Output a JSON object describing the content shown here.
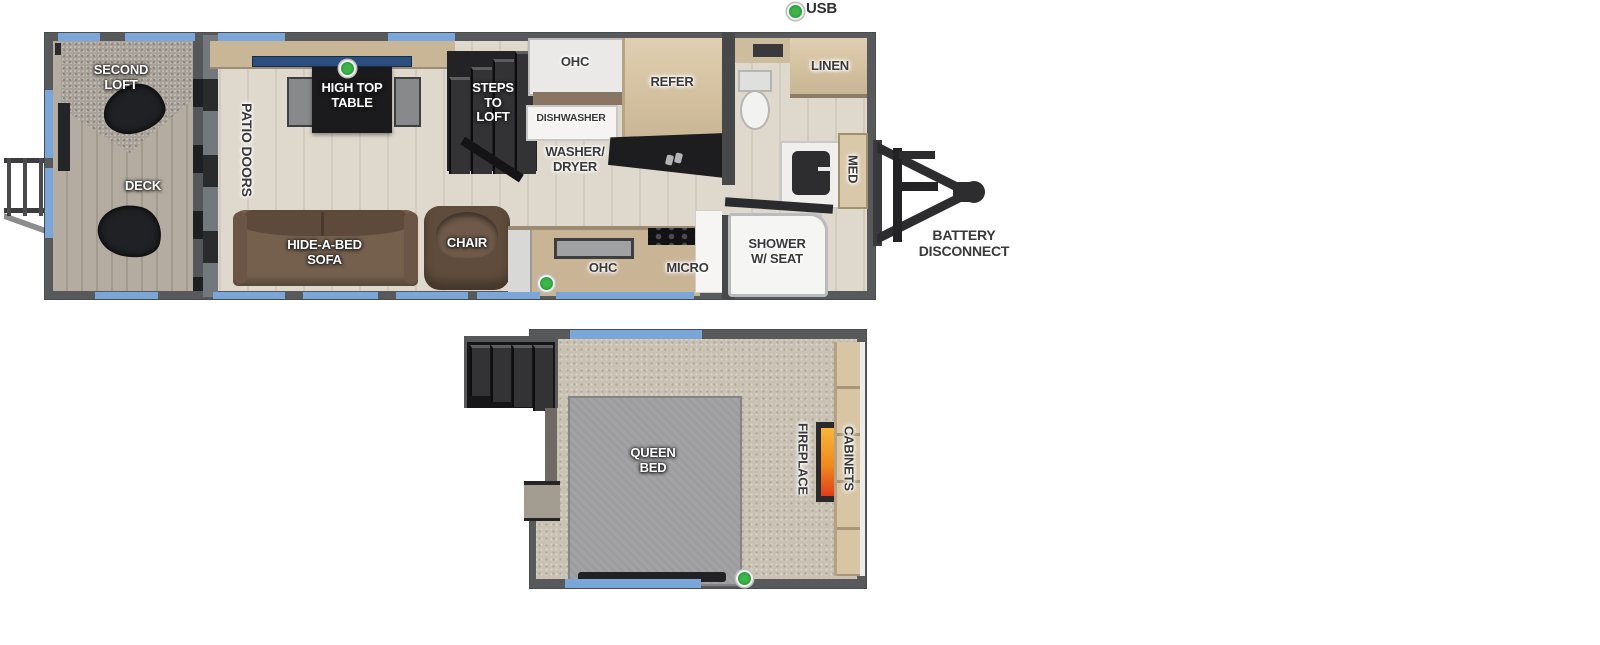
{
  "legend": {
    "usb_label": "USB"
  },
  "main_floor": {
    "second_loft": "SECOND\nLOFT",
    "deck": "DECK",
    "patio_doors": "PATIO DOORS",
    "high_top_table": "HIGH TOP\nTABLE",
    "steps_to_loft": "STEPS\nTO\nLOFT",
    "ohc_top": "OHC",
    "dishwasher": "DISHWASHER",
    "refer": "REFER",
    "washer_dryer": "WASHER/\nDRYER",
    "linen": "LINEN",
    "med": "MED",
    "shower": "SHOWER\nW/ SEAT",
    "sofa": "HIDE-A-BED\nSOFA",
    "chair": "CHAIR",
    "ohc_bottom": "OHC",
    "micro": "MICRO"
  },
  "loft_floor": {
    "queen_bed": "QUEEN\nBED",
    "fireplace": "FIREPLACE",
    "cabinets": "CABINETS"
  },
  "exterior": {
    "battery_disconnect": "BATTERY\nDISCONNECT"
  },
  "icons": {
    "usb_indicator": "green-dot",
    "washer_dryer_icon": "stacked-laundry-glyph",
    "fireplace_flame": "flame-strip",
    "trailer_hitch": "a-frame-tongue-with-coupler"
  },
  "colors": {
    "wall": "#58595b",
    "window_blue": "#7ba6d9",
    "usb_green": "#3cb64b",
    "flame_orange": "#f08a1e",
    "cabinet_wood": "#d7c4a3",
    "floor_wood": "#d9d2c6",
    "carpet": "#c9c2b4",
    "sofa_brown": "#6b5343",
    "table_black": "#1b1b1d",
    "bed_gray": "#9d9da0",
    "counter_window_blue": "#2c4e7d"
  }
}
